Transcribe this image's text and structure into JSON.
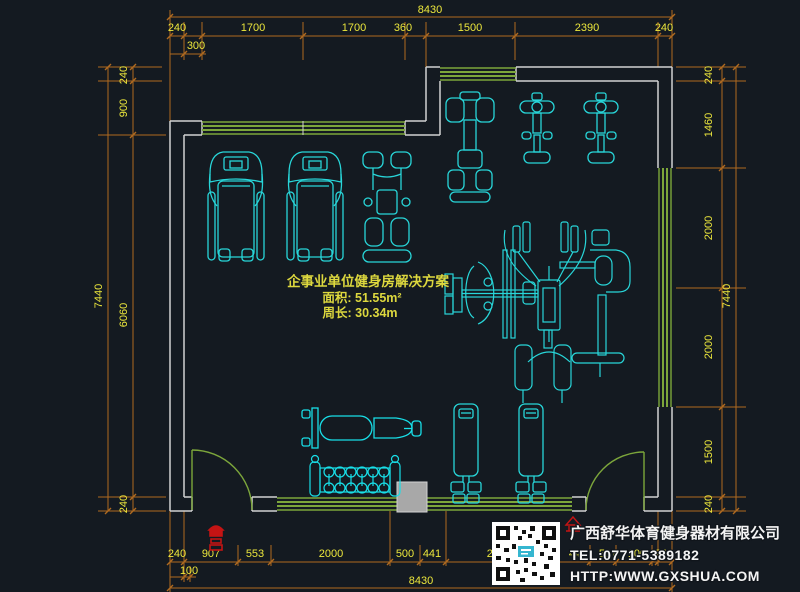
{
  "plan_label": {
    "title": "企事业单位健身房解决方案",
    "area": "面积: 51.55m²",
    "perimeter": "周长: 30.34m"
  },
  "title_block": {
    "company": "广西舒华体育健身器材有限公司",
    "tel": "TEL:0771-5389182",
    "website": "HTTP:WWW.GXSHUA.COM",
    "qr_icon": "qr-code"
  },
  "dimensions": {
    "top": {
      "overall": "8430",
      "sub": "300",
      "chain": [
        "240",
        "1700",
        "1700",
        "360",
        "1500",
        "2390",
        "240"
      ]
    },
    "bottom": {
      "overall": "8430",
      "sub": "100",
      "chain": [
        "240",
        "907",
        "553",
        "2000",
        "500",
        "441",
        "2410",
        "442",
        "597",
        "100",
        "240"
      ]
    },
    "left": {
      "overall": "7440",
      "chain": [
        "240",
        "900",
        "6060",
        "240"
      ]
    },
    "right": {
      "overall": "7440",
      "chain": [
        "240",
        "1460",
        "2000",
        "2000",
        "1500",
        "240"
      ]
    }
  },
  "equipment": [
    "treadmill",
    "treadmill",
    "seated-leg-machine",
    "multi-press-machine",
    "elliptical-bike",
    "elliptical-bike",
    "four-station-jungle-gym",
    "massage-bench",
    "dumbbell-rack",
    "vertical-strength-machine",
    "vertical-strength-machine",
    "column",
    "fire-hydrant"
  ],
  "colors": {
    "background": "#141a21",
    "wall": "#d2d2d2",
    "window": "#7ca63b",
    "equipment": "#28d6d9",
    "dimension_line": "#b06a20",
    "dimension_text": "#ece73c",
    "label_text": "#ddd83e",
    "column": "#a8a8a8",
    "accent_red": "#c41414"
  }
}
